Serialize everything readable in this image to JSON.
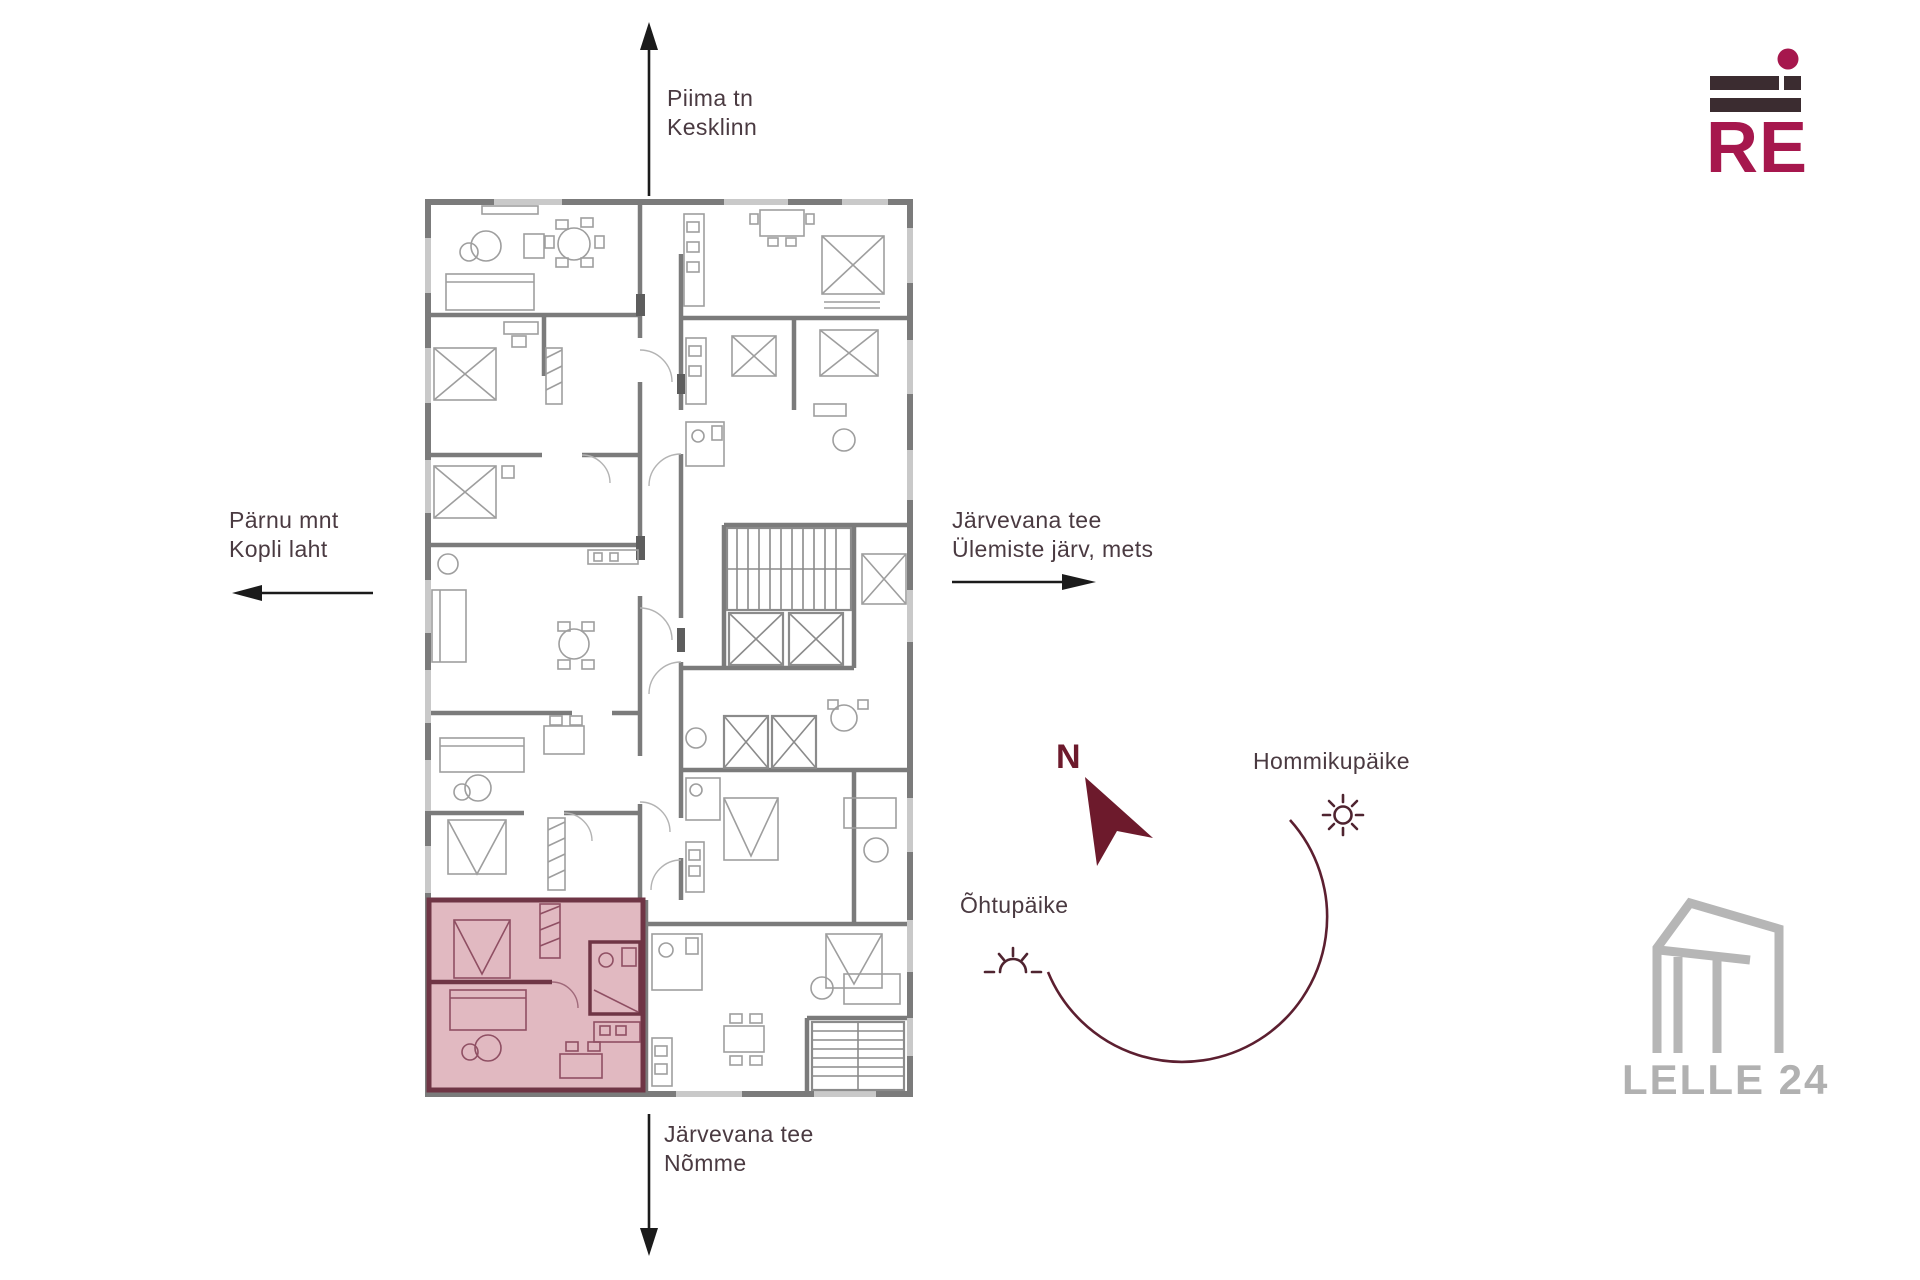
{
  "brand": {
    "logo_text": "RE"
  },
  "watermark": {
    "label": "LELLE 24"
  },
  "compass": {
    "north": "N"
  },
  "directions": {
    "north": {
      "line1": "Piima tn",
      "line2": "Kesklinn"
    },
    "west": {
      "line1": "Pärnu mnt",
      "line2": "Kopli laht"
    },
    "east": {
      "line1": "Järvevana tee",
      "line2": "Ülemiste järv, mets"
    },
    "south": {
      "line1": "Järvevana tee",
      "line2": "Nõmme"
    }
  },
  "sunlight": {
    "morning": "Hommikupäike",
    "evening": "Õhtupäike"
  },
  "colors": {
    "accent_maroon": "#6d1a2c",
    "arc_maroon": "#5c1f30",
    "logo_crimson": "#a6174d",
    "logo_dark": "#3b2c30",
    "label_text": "#4a3a41",
    "plan_wall": "#7b7b7b",
    "plan_window": "#c9c9c9",
    "plan_furniture": "#9e9e9e",
    "highlight_fill": "#c47384",
    "highlight_wall": "#6f3545",
    "watermark_gray": "#b1b1b1"
  }
}
